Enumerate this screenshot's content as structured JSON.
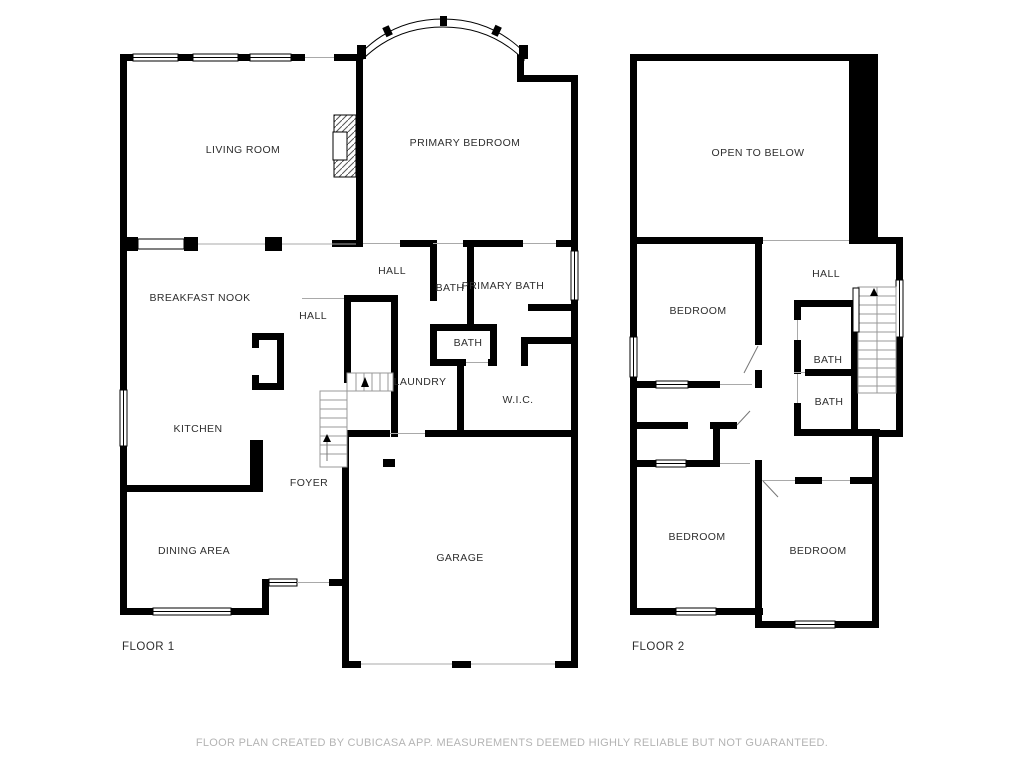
{
  "floor1": {
    "title": "FLOOR 1",
    "rooms": {
      "living_room": "LIVING ROOM",
      "primary_bedroom": "PRIMARY BEDROOM",
      "hall_upper": "HALL",
      "bath_upper": "BATH",
      "primary_bath": "PRIMARY BATH",
      "breakfast_nook": "BREAKFAST NOOK",
      "hall_lower": "HALL",
      "bath_center": "BATH",
      "laundry": "LAUNDRY",
      "wic": "W.I.C.",
      "kitchen": "KITCHEN",
      "foyer": "FOYER",
      "dining_area": "DINING AREA",
      "garage": "GARAGE"
    }
  },
  "floor2": {
    "title": "FLOOR 2",
    "rooms": {
      "open_to_below": "OPEN TO BELOW",
      "bedroom_top": "BEDROOM",
      "hall": "HALL",
      "bath_upper": "BATH",
      "bath_lower": "BATH",
      "bedroom_left": "BEDROOM",
      "bedroom_right": "BEDROOM"
    }
  },
  "footer": "FLOOR PLAN CREATED BY CUBICASA APP. MEASUREMENTS DEEMED HIGHLY RELIABLE BUT NOT GUARANTEED.",
  "colors": {
    "wall": "#000000",
    "background": "#ffffff",
    "label_text": "#2e2e2e",
    "footer_text": "#b4b4b4"
  }
}
